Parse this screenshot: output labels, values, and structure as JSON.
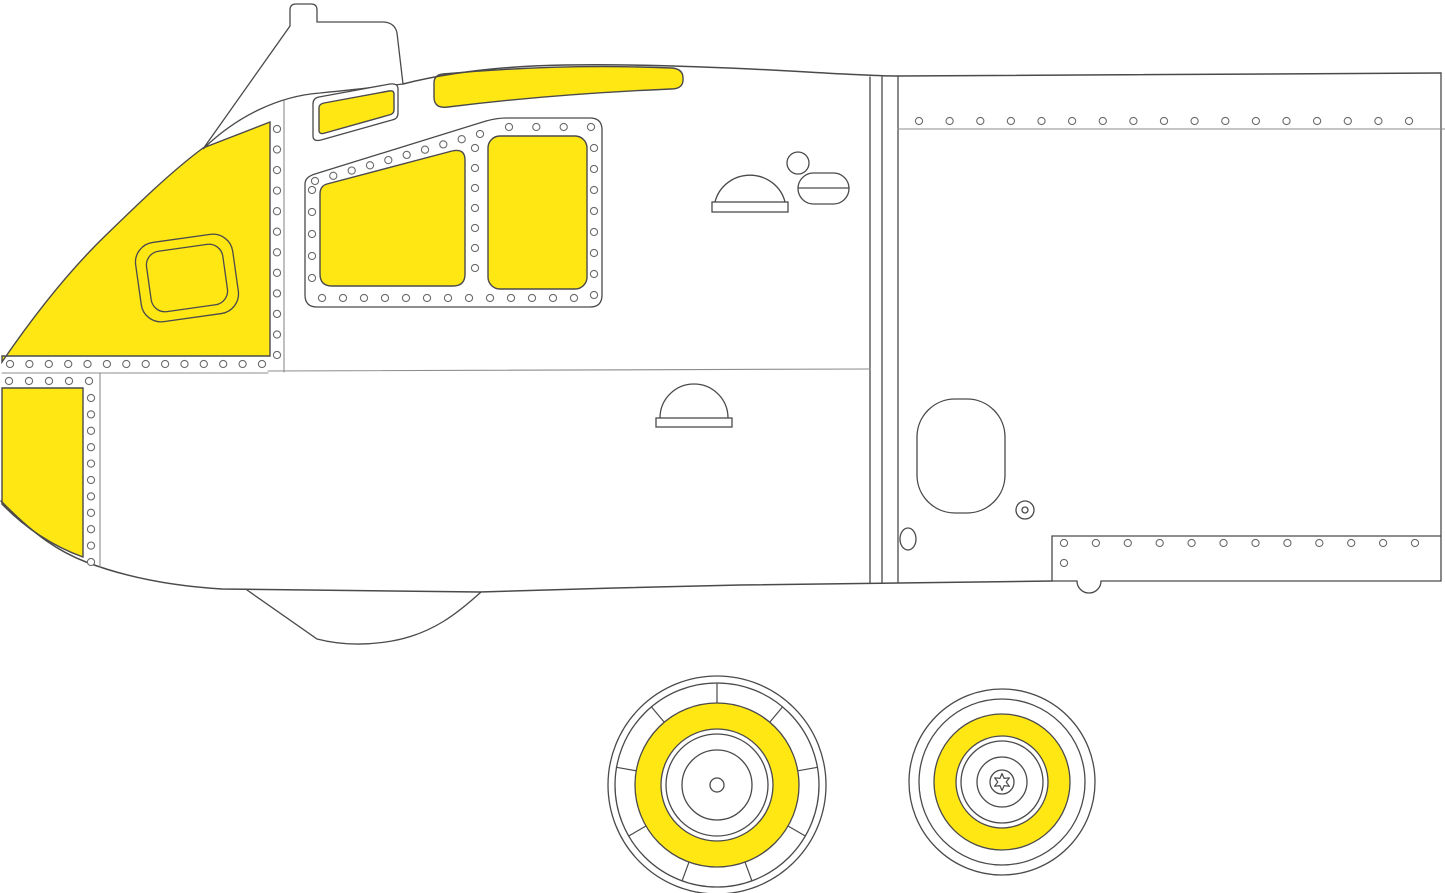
{
  "document": {
    "description": "Line-art masking guide: aircraft forward fuselage side profile with yellow canopy masks and two wheel-hub masks"
  },
  "colors": {
    "background": "#ffffff",
    "mask_yellow": "#ffe714",
    "outline": "#4a4a4c",
    "line_light": "#8c8c8e",
    "rivet": "#6b6b6d"
  },
  "canvas": {
    "width": 1445,
    "height": 893
  },
  "rivets": {
    "radius": 3.6,
    "rows": [
      {
        "name": "nose-column",
        "x1": 277,
        "y1": 129,
        "x2": 277,
        "y2": 355,
        "n": 12
      },
      {
        "name": "nose-bottom-row",
        "x1": 10,
        "y1": 364,
        "x2": 262,
        "y2": 364,
        "n": 14
      },
      {
        "name": "cheek-row",
        "x1": 9,
        "y1": 381,
        "x2": 89,
        "y2": 381,
        "n": 5
      },
      {
        "name": "cheek-column",
        "x1": 91,
        "y1": 398,
        "x2": 91,
        "y2": 562,
        "n": 11
      },
      {
        "name": "panel-slant-row",
        "x1": 315,
        "y1": 181,
        "x2": 480,
        "y2": 134,
        "n": 10
      },
      {
        "name": "panel-top-row",
        "x1": 509,
        "y1": 127,
        "x2": 591,
        "y2": 127,
        "n": 4
      },
      {
        "name": "panel-right-column",
        "x1": 594,
        "y1": 148,
        "x2": 594,
        "y2": 295,
        "n": 8
      },
      {
        "name": "panel-bottom-row",
        "x1": 322,
        "y1": 298,
        "x2": 574,
        "y2": 298,
        "n": 13
      },
      {
        "name": "panel-left-column",
        "x1": 312,
        "y1": 190,
        "x2": 312,
        "y2": 278,
        "n": 5
      },
      {
        "name": "panel-divider-column",
        "x1": 475,
        "y1": 148,
        "x2": 475,
        "y2": 268,
        "n": 7
      },
      {
        "name": "upper-right-row",
        "x1": 919,
        "y1": 121,
        "x2": 1409,
        "y2": 121,
        "n": 17
      },
      {
        "name": "lower-right-row",
        "x1": 1064,
        "y1": 543,
        "x2": 1415,
        "y2": 543,
        "n": 12
      },
      {
        "name": "lower-right-single",
        "x1": 1064,
        "y1": 563,
        "x2": 1064,
        "y2": 563,
        "n": 1
      }
    ]
  },
  "wheels": [
    {
      "name": "main-wheel-mask",
      "cx": 717,
      "cy": 785,
      "outline_radii": [
        109,
        102,
        82,
        56,
        51,
        35
      ],
      "yellow_ring": {
        "outer": 82,
        "inner": 56
      },
      "spokes": {
        "count": 9,
        "inner_radius": 82,
        "outer_radius": 102,
        "start_angle_deg": 90
      },
      "hub": {
        "type": "circle",
        "radius": 7
      }
    },
    {
      "name": "nose-wheel-mask",
      "cx": 1002,
      "cy": 782,
      "outline_radii": [
        93,
        83,
        68,
        46,
        41,
        25,
        12
      ],
      "yellow_ring": {
        "outer": 68,
        "inner": 46
      },
      "spokes": null,
      "hub": {
        "type": "star",
        "outer_radius": 8.5,
        "inner_radius": 4.2,
        "points": 6
      }
    }
  ]
}
